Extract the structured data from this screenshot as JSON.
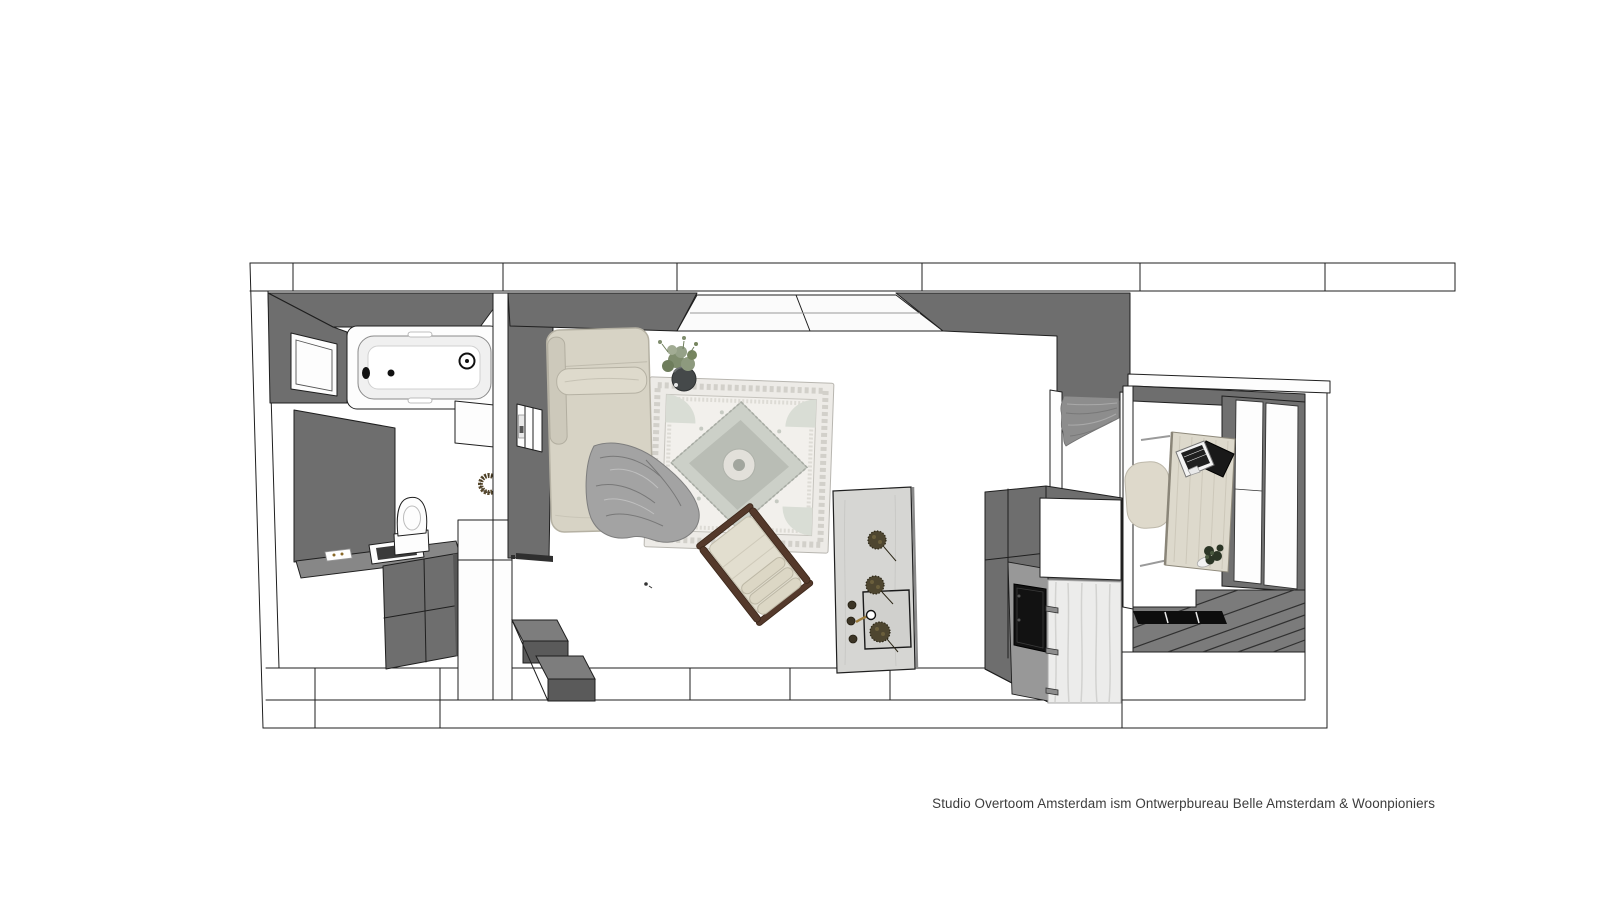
{
  "caption": "Studio Overtoom Amsterdam ism Ontwerpbureau Belle Amsterdam & Woonpioniers",
  "colors": {
    "c-paper": "#ffffff",
    "c-outline": "#1f1f1f",
    "c-wall": "#6e6e6e",
    "c-wall-dark": "#5a5a5a",
    "c-wall-light": "#7d7d7d",
    "c-fixture": "#fdfdfd",
    "c-bed": "#d7d3c5",
    "c-bed-trim": "#b5b1a3",
    "c-blanket": "#a3a3a3",
    "c-rug": "#edebe7",
    "c-rug-field": "#f2f0ec",
    "c-rug-motif": "#ccd0c8",
    "c-wood": "#54392b",
    "c-cushion": "#e2decf",
    "c-island": "#d6d6d3",
    "c-flower": "#4e4630",
    "c-brass": "#9c7c3c",
    "c-oven": "#121212",
    "c-marble": "#ececeb",
    "c-desk": "#ddd9cc",
    "c-laptop": "#191919",
    "c-green": "#7f8d6e",
    "c-green-dark": "#2c3626",
    "c-plank": "#7b7b7b",
    "c-tread": "#0d0d0d",
    "c-curtain": "#8d8d8d",
    "c-caption": "#3c3c3c"
  }
}
